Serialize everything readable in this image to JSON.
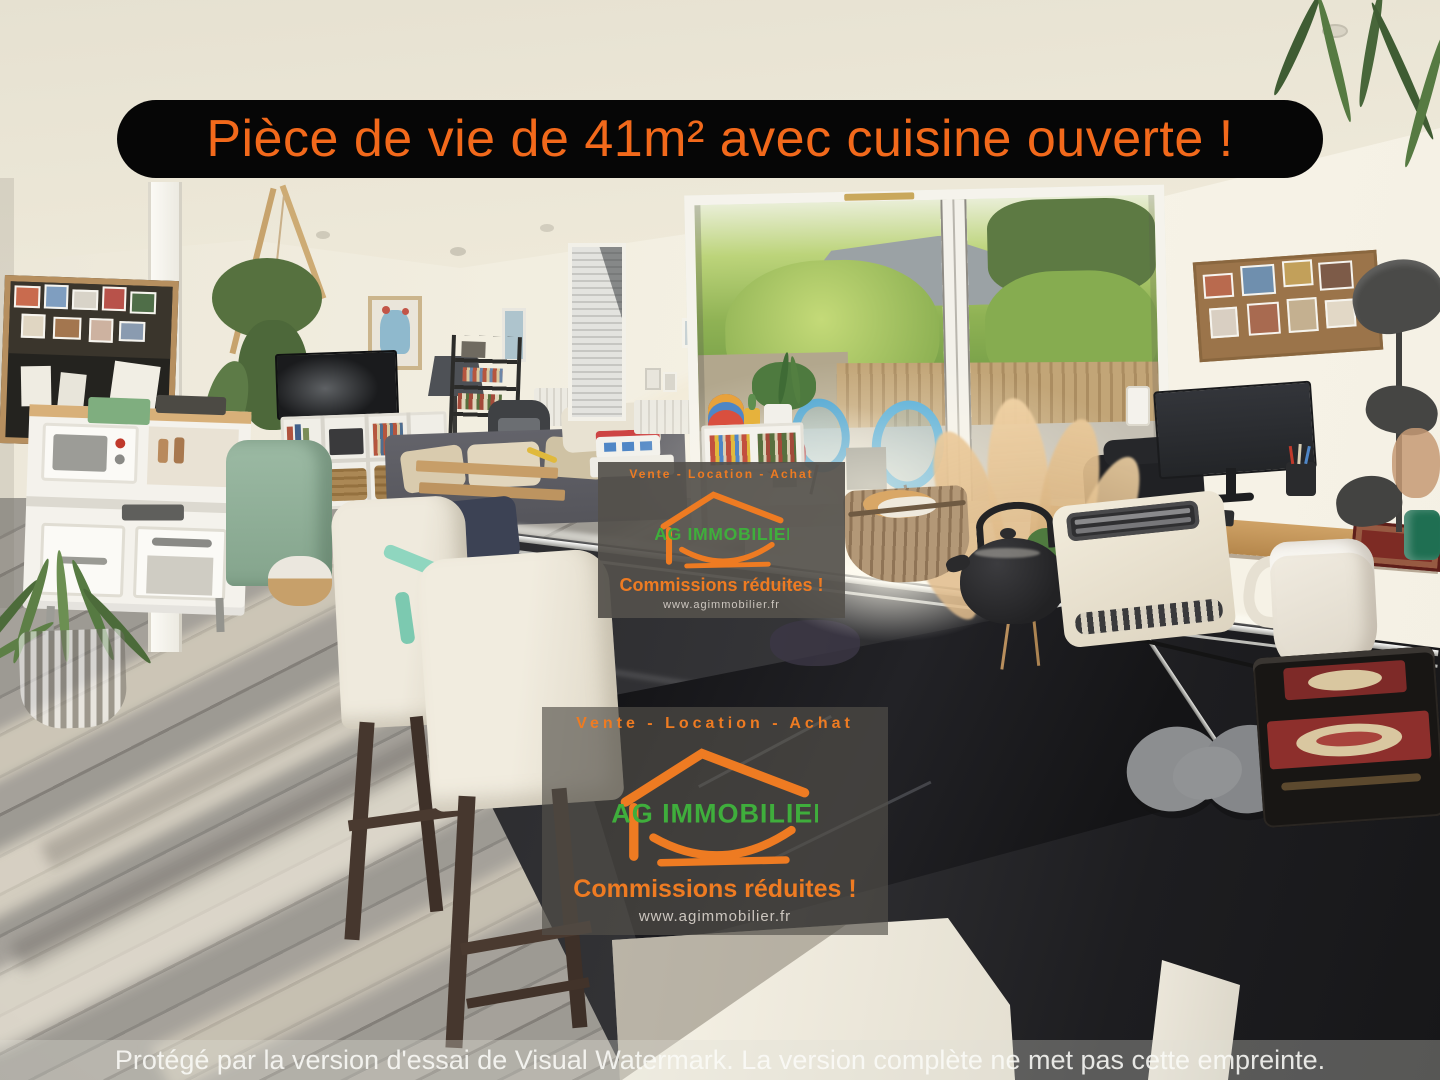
{
  "banner": {
    "text": "Pièce de vie de 41m² avec cuisine ouverte !"
  },
  "watermark": {
    "tagline": "Vente - Location - Achat",
    "brand": "AG IMMOBILIER",
    "slogan": "Commissions réduites !",
    "website": "www.agimmobilier.fr"
  },
  "trial_notice": "Protégé par la version d'essai de Visual Watermark. La version complète ne met pas cette empreinte.",
  "colors": {
    "banner_background": "#060606",
    "banner_text": "#F2691B",
    "logo_orange": "#EE7B22",
    "logo_green": "#3FAE3C",
    "watermark_background": "#54504B",
    "watermark_link_gray": "#CCC6BF",
    "notice_text": "#F7F6F3"
  }
}
